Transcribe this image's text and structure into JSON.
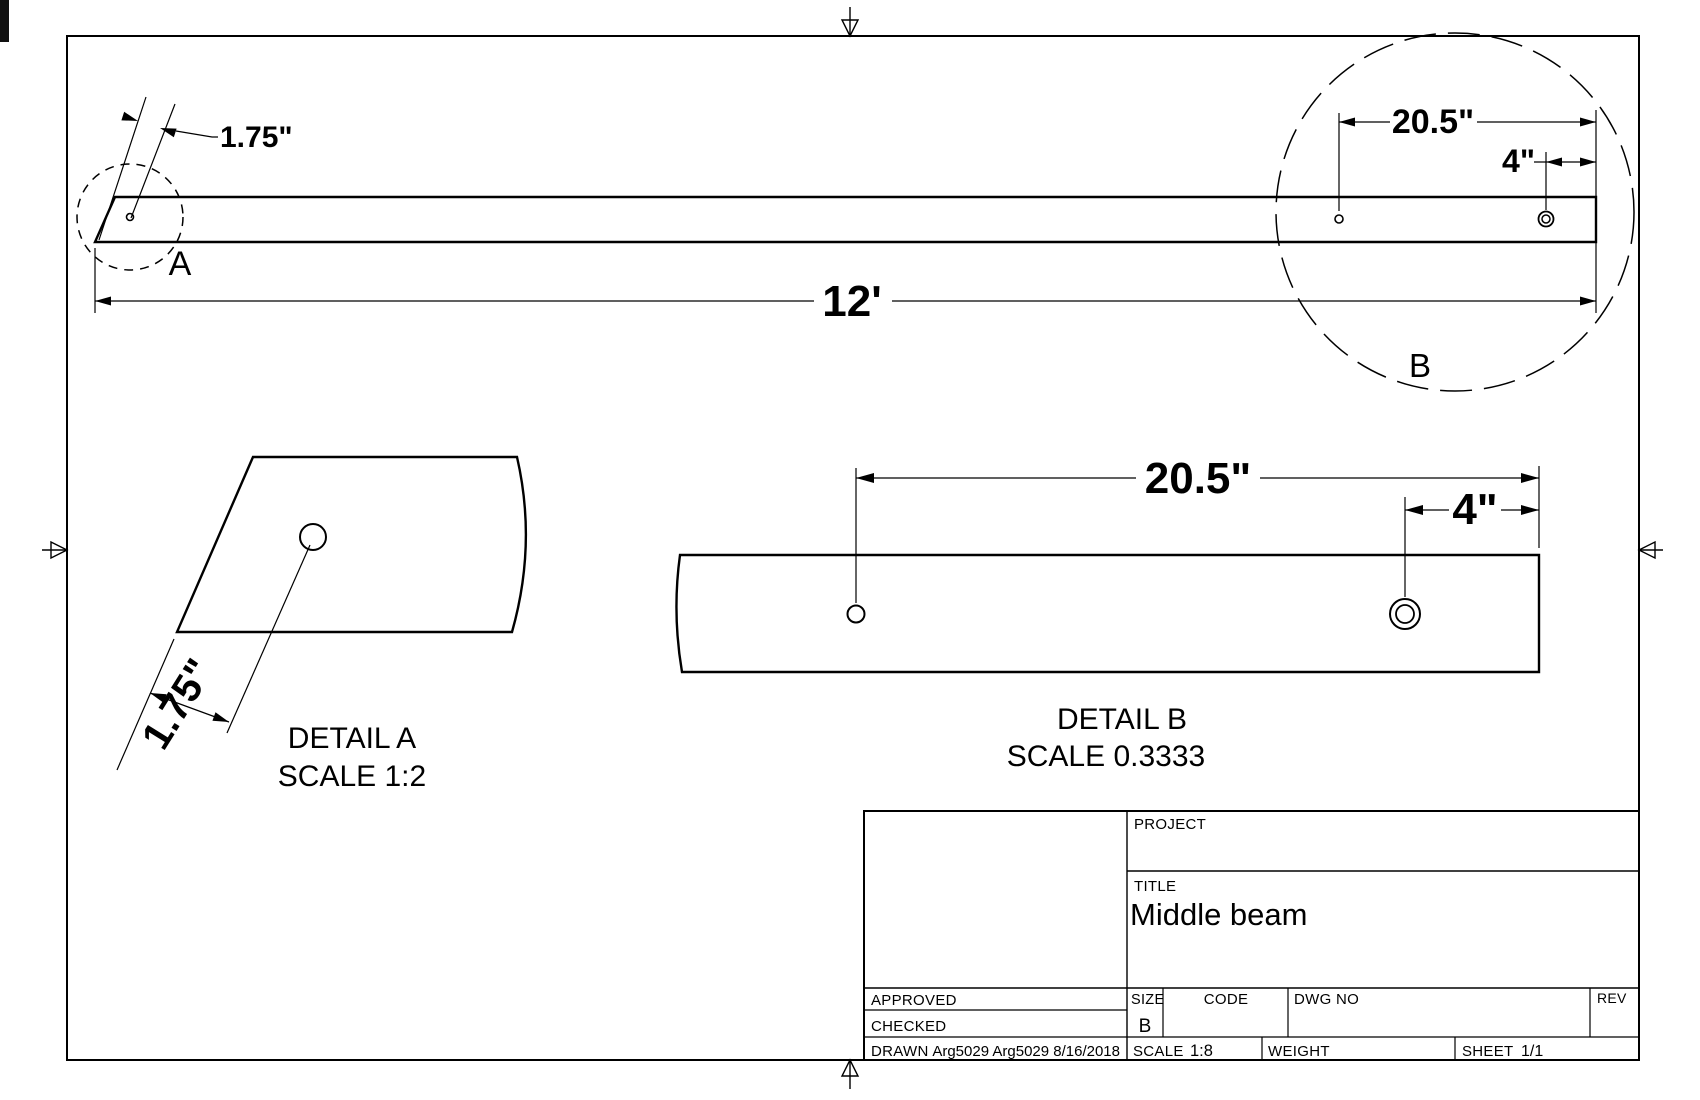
{
  "colors": {
    "dim_red": "#ec1414",
    "line": "#000000"
  },
  "drawing": {
    "main_view": {
      "detail_marker_a": "A",
      "detail_marker_b": "B",
      "dim_hole_offset": "1.75\"",
      "dim_length": "12'",
      "dim_hole_spacing": "20.5\"",
      "dim_hole_end": "4\""
    },
    "detail_a": {
      "title": "DETAIL A",
      "scale": "SCALE 1:2",
      "dim_hole_offset": "1.75\""
    },
    "detail_b": {
      "title": "DETAIL B",
      "scale": "SCALE 0.3333",
      "dim_hole_spacing": "20.5\"",
      "dim_hole_end": "4\""
    }
  },
  "title_block": {
    "project_label": "PROJECT",
    "title_label": "TITLE",
    "title_value": "Middle beam",
    "approved_label": "APPROVED",
    "checked_label": "CHECKED",
    "drawn_label": "DRAWN",
    "drawn_value": "Arg5029 Arg5029 8/16/2018",
    "size_label": "SIZE",
    "size_value": "B",
    "code_label": "CODE",
    "dwg_no_label": "DWG NO",
    "rev_label": "REV",
    "scale_label": "SCALE",
    "scale_value": "1:8",
    "weight_label": "WEIGHT",
    "sheet_label": "SHEET",
    "sheet_value": "1/1"
  }
}
